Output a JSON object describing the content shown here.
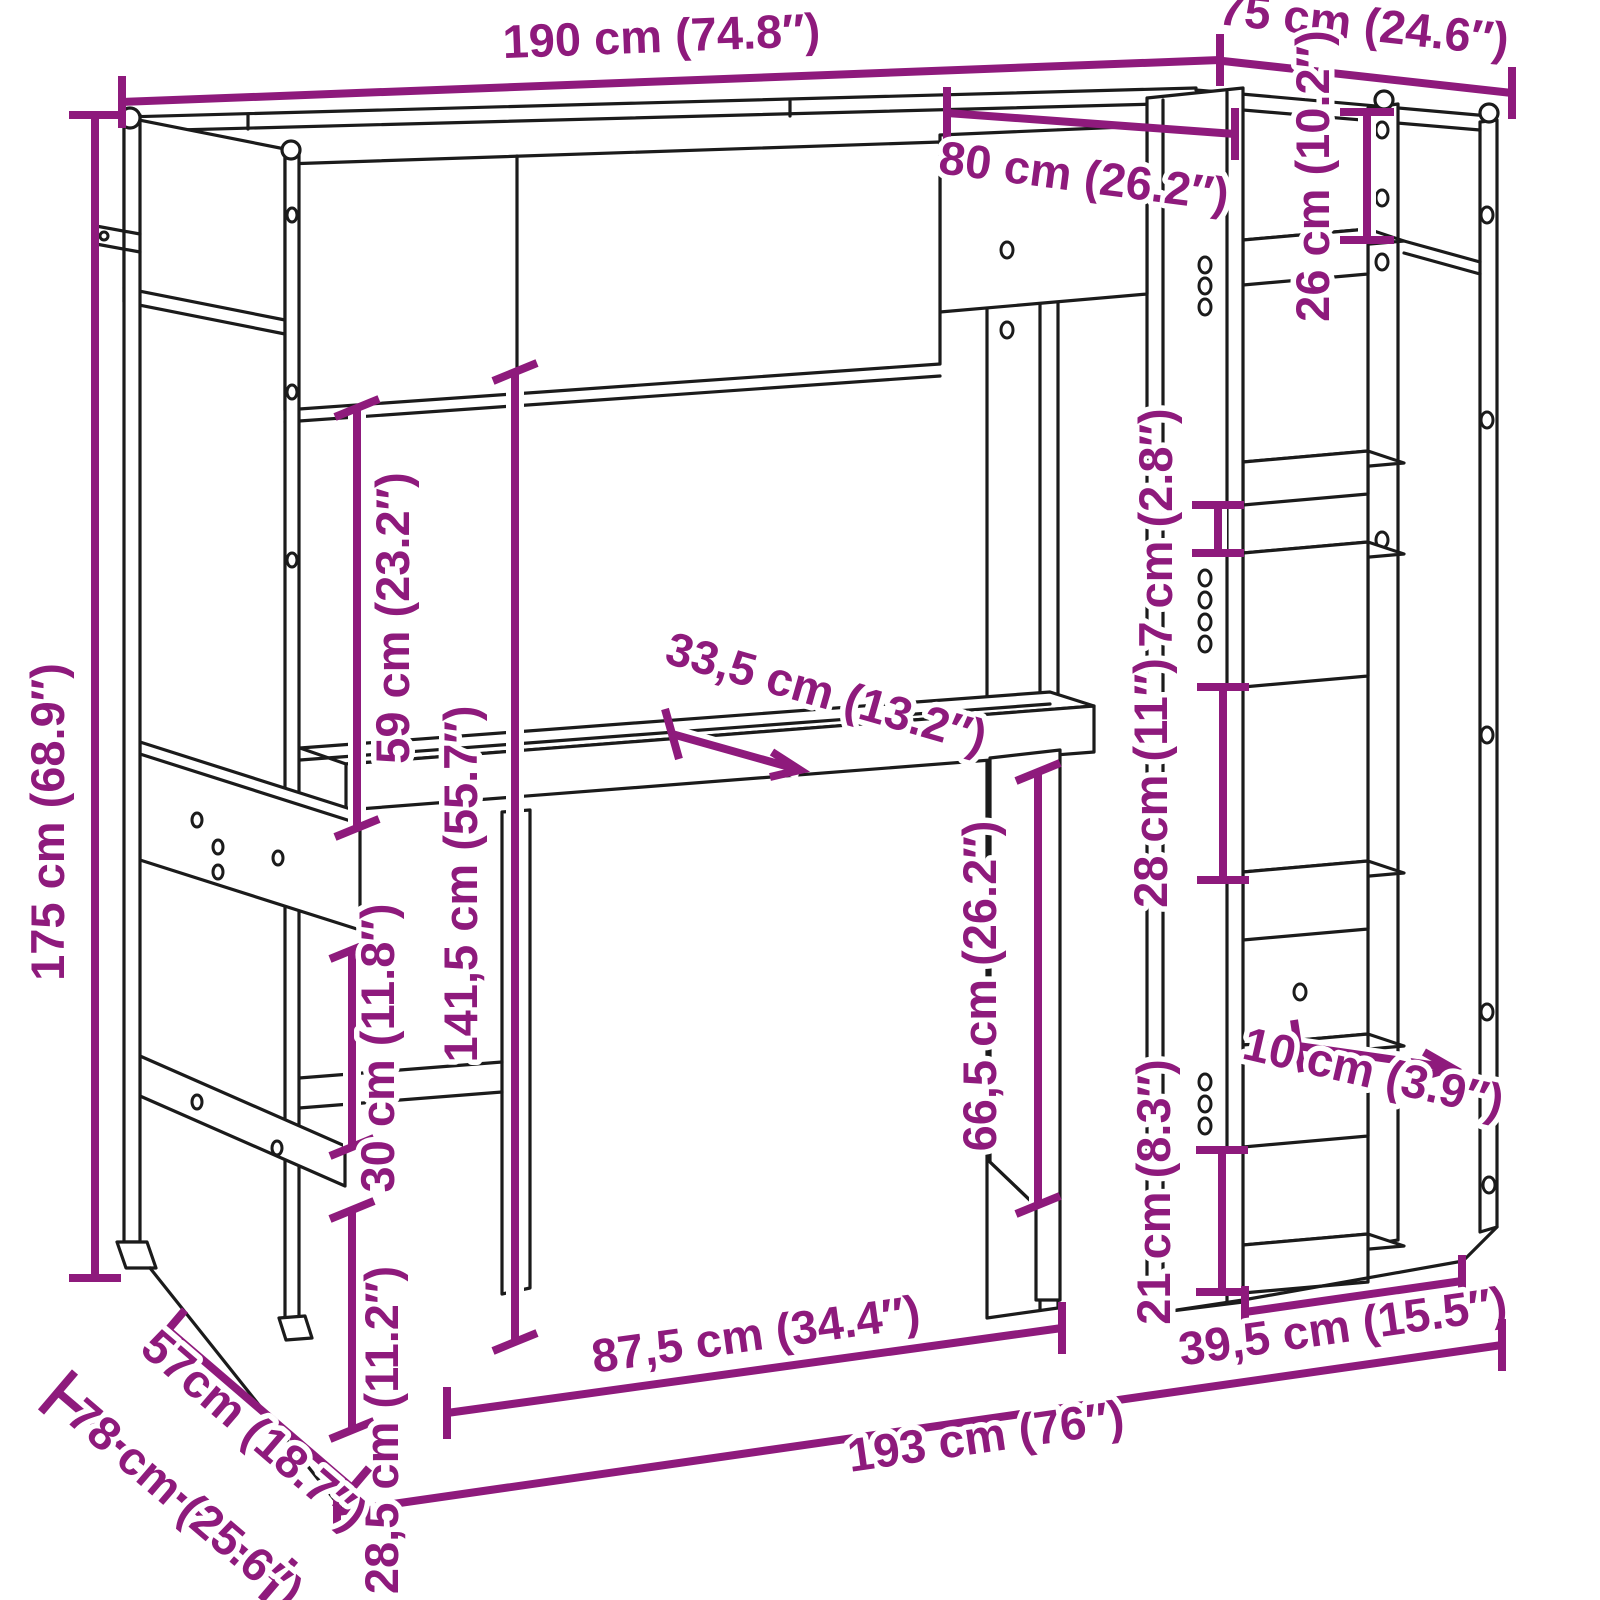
{
  "drawing": {
    "background_color": "#ffffff",
    "line_color": "#1b1b1b",
    "dimension_color": "#8E1A7C",
    "units": "cm / inches"
  },
  "dimensions": {
    "overall_width_top": {
      "label": "190 cm (74.8″)"
    },
    "depth_top": {
      "label": "75 cm (24.6″)"
    },
    "inner_top_width": {
      "label": "80 cm (26.2″)"
    },
    "top_shelf_gap": {
      "label": "26 cm (10.2″)"
    },
    "clearance_above_desk": {
      "label": "59 cm (23.2″)"
    },
    "overall_height": {
      "label": "175 cm (68.9″)"
    },
    "height_under_bed": {
      "label": "141,5 cm (55.7″)"
    },
    "desk_depth": {
      "label": "33,5 cm (13.2″)"
    },
    "small_shelf_gap": {
      "label": "7 cm (2.8″)"
    },
    "middle_shelf_gap": {
      "label": "28 cm (11″)"
    },
    "clearance_under_desk": {
      "label": "66,5 cm (26.2″)"
    },
    "shelf_board_depth": {
      "label": "10 cm (3.9″)"
    },
    "bottom_shelf_gap": {
      "label": "21 cm (8.3″)"
    },
    "shelf_unit_width": {
      "label": "39,5 cm (15.5″)"
    },
    "desk_width": {
      "label": "87,5 cm (34.4″)"
    },
    "overall_width_bottom": {
      "label": "193 cm (76″)"
    },
    "lower_board_height": {
      "label": "28,5 cm (11.2″)"
    },
    "lower_board_gap": {
      "label": "30 cm (11.8″)"
    },
    "side_shelf_depth": {
      "label": "57cm (18.7″)"
    },
    "overall_depth_bottom": {
      "label": "78 cm (25.6″)"
    }
  }
}
